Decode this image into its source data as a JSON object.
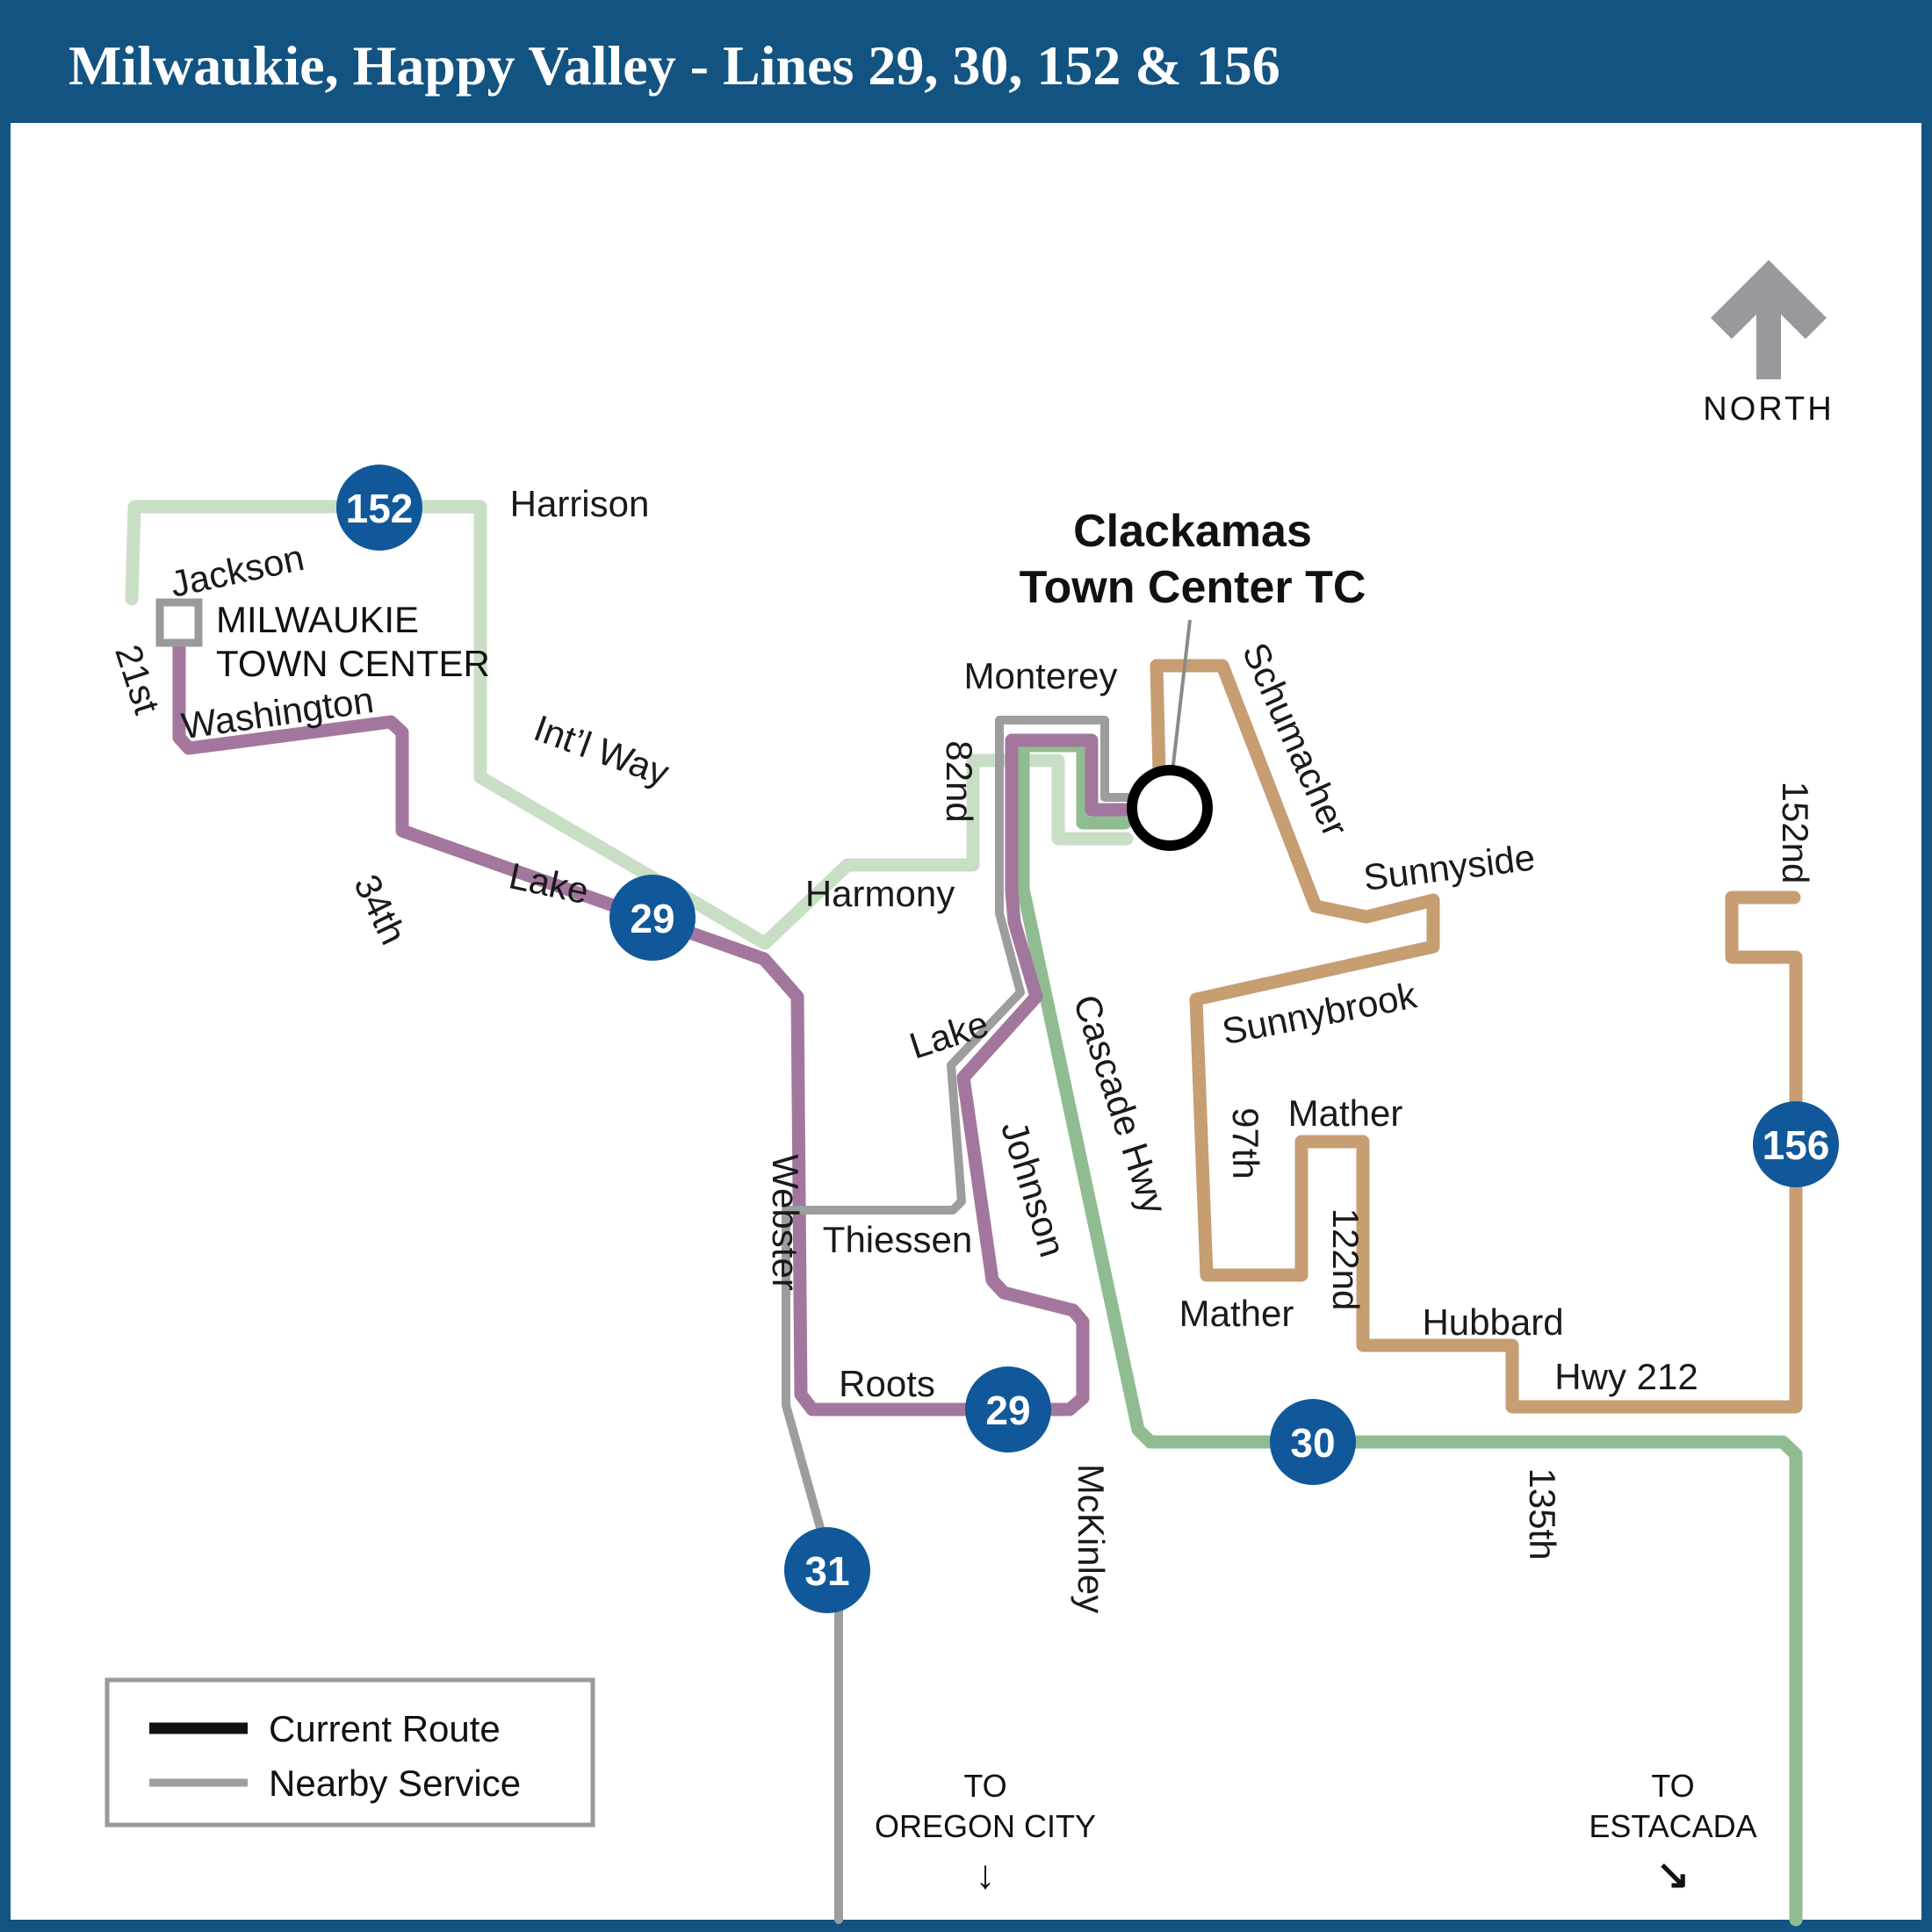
{
  "header": {
    "title": "Milwaukie, Happy Valley - Lines 29, 30, 152 & 156"
  },
  "colors": {
    "header_bg": "#125381",
    "frame": "#125381",
    "badge": "#10589a",
    "route152": "#c9dfc5",
    "route30": "#8fbc90",
    "route29": "#a3779d",
    "route156": "#c79d72",
    "nearby_gray": "#9d9d9d",
    "leader_gray": "#8a8a8a",
    "north_gray": "#97999c",
    "legend_border": "#9a9a9a",
    "current_route_sample": "#111111"
  },
  "north": {
    "label": "NORTH"
  },
  "badges": {
    "b152": "152",
    "b29": "29",
    "b30": "30",
    "b31": "31",
    "b156": "156"
  },
  "stations": {
    "milwaukie_line1": "MILWAUKIE",
    "milwaukie_line2": "TOWN CENTER",
    "clackamas_line1": "Clackamas",
    "clackamas_line2": "Town Center TC"
  },
  "streets": {
    "harrison": "Harrison",
    "jackson": "Jackson",
    "st21": "21st",
    "washington": "Washington",
    "th34": "34th",
    "lake_west": "Lake",
    "intl_way": "Int’l Way",
    "harmony": "Harmony",
    "monterey": "Monterey",
    "nd82": "82nd",
    "schumacher": "Schumacher",
    "sunnyside": "Sunnyside",
    "sunnybrook": "Sunnybrook",
    "th97": "97th",
    "mather": "Mather",
    "nd122": "122nd",
    "hubbard": "Hubbard",
    "hwy212": "Hwy 212",
    "th135": "135th",
    "nd152": "152nd",
    "webster": "Webster",
    "lake_east": "Lake",
    "johnson": "Johnson",
    "thiessen": "Thiessen",
    "roots": "Roots",
    "mckinley": "McKinley",
    "cascade_hwy": "Cascade Hwy"
  },
  "legend": {
    "current": "Current Route",
    "nearby": "Nearby Service"
  },
  "directions": {
    "oregon_city_line1": "TO",
    "oregon_city_line2": "OREGON CITY",
    "oregon_city_arrow": "↓",
    "estacada_line1": "TO",
    "estacada_line2": "ESTACADA",
    "estacada_arrow": "↘"
  }
}
